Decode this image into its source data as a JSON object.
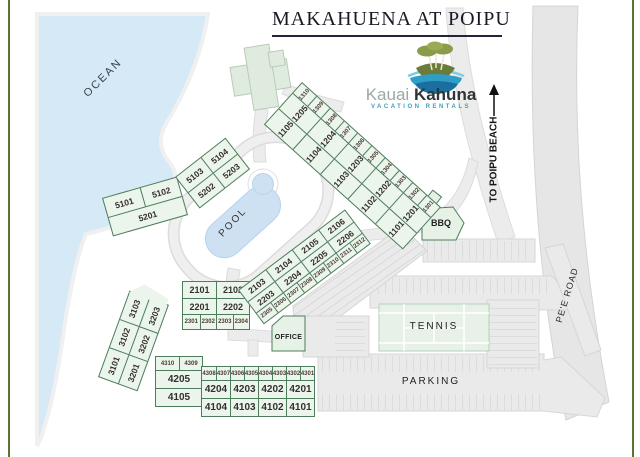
{
  "title": "MAKAHUENA AT POIPU",
  "logo": {
    "word1": "Kauai",
    "word2": "Kahuna",
    "tagline": "VACATION RENTALS"
  },
  "labels": {
    "ocean": "OCEAN",
    "pool": "POOL",
    "tennis": "TENNIS",
    "parking": "PARKING",
    "bbq": "BBQ",
    "office": "OFFICE",
    "road": "PE'E ROAD",
    "beach_arrow": "TO POIPU BEACH"
  },
  "buildings": {
    "b1": {
      "small": [
        "1310",
        "1309",
        "1308",
        "1307",
        "1306",
        "1305",
        "1304",
        "1303",
        "1302",
        "1301"
      ],
      "mid": [
        "1205",
        "1204",
        "1203",
        "1202",
        "1201"
      ],
      "low": [
        "1105",
        "1104",
        "1103",
        "1102",
        "1101"
      ]
    },
    "b2main": {
      "r1": [
        "2101",
        "2102"
      ],
      "r2": [
        "2201",
        "2202"
      ],
      "r3": [
        "2301",
        "2302",
        "2303",
        "2304"
      ]
    },
    "b2wing": {
      "r1": [
        "2103",
        "2104",
        "2105",
        "2106"
      ],
      "r2": [
        "2203",
        "2204",
        "2205",
        "2206"
      ],
      "r3": [
        "2305",
        "2306",
        "2307",
        "2308",
        "2309",
        "2310",
        "2311",
        "2312"
      ]
    },
    "b3": {
      "r1": [
        "3101",
        "3102",
        "3103"
      ],
      "r2": [
        "3201",
        "3202",
        "3203"
      ]
    },
    "b4left": {
      "r1": [
        "4310",
        "4309"
      ],
      "r2": [
        "4205"
      ],
      "r3": [
        "4105"
      ]
    },
    "b4right": {
      "r1": [
        "4308",
        "4307",
        "4306",
        "4305",
        "4304",
        "4303",
        "4302",
        "4301"
      ],
      "r2": [
        "4204",
        "4203",
        "4202",
        "4201"
      ],
      "r3": [
        "4104",
        "4103",
        "4102",
        "4101"
      ]
    },
    "b5a": {
      "r1": [
        "5101",
        "5102"
      ],
      "r2": [
        "5201"
      ]
    },
    "b5b": {
      "r1": [
        "5103",
        "5104"
      ],
      "r2": [
        "5202",
        "5203"
      ]
    }
  },
  "colors": {
    "building_fill": "#ebf5ec",
    "building_border": "#4d7c5a",
    "ocean_blue": "#d6e9f7",
    "pool_blue": "#cde1f3",
    "road_gray": "#ececec",
    "frame_green": "#5a7331",
    "brand_teal": "#3fa0ba",
    "title_ink": "#191925"
  }
}
